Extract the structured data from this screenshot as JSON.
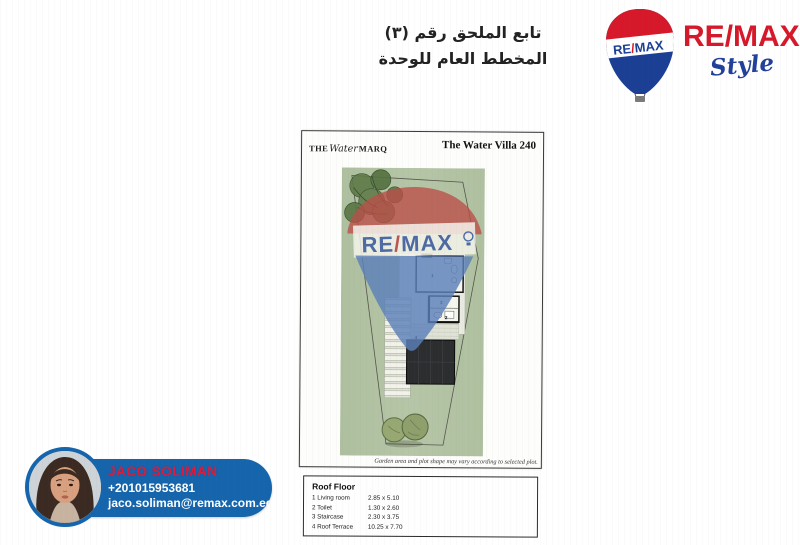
{
  "header": {
    "arabic_line1": "تابع الملحق رقم (٣)",
    "arabic_line2": "المخطط العام للوحدة"
  },
  "brand": {
    "balloon_re": "RE",
    "balloon_slash": "/",
    "balloon_max": "MAX",
    "wordmark_re": "RE",
    "wordmark_slash": "/",
    "wordmark_max": "MAX",
    "registered": "®",
    "style_script": "Style"
  },
  "sheet": {
    "logo": {
      "the": "THE",
      "script": "Water",
      "marq": "MARQ"
    },
    "title": "The Water Villa 240",
    "watermark": {
      "re": "RE",
      "slash": "/",
      "max": "MAX"
    },
    "plan_labels": {
      "living": "1",
      "toilet": "2",
      "stair": "3",
      "terrace": "4"
    },
    "caption": "Garden area and plot shape may vary according to selected plot.",
    "table": {
      "header": "Roof Floor",
      "rows": [
        {
          "name": "1 Living room",
          "dims": "2.85 x 5.10"
        },
        {
          "name": "2 Toilet",
          "dims": "1.30 x 2.60"
        },
        {
          "name": "3 Staircase",
          "dims": "2.30 x 3.75"
        },
        {
          "name": "4 Roof Terrace",
          "dims": "10.25 x 7.70"
        }
      ]
    }
  },
  "agent": {
    "name": "JACO SOLIMAN",
    "phone": "+201015953681",
    "email": "jaco.soliman@remax.com.eg"
  },
  "colors": {
    "remax_red": "#d7182a",
    "remax_blue": "#1b3f94",
    "pill_blue": "#1565ad",
    "name_red": "#e11a3c",
    "plan_green": "#b3c4a4"
  }
}
